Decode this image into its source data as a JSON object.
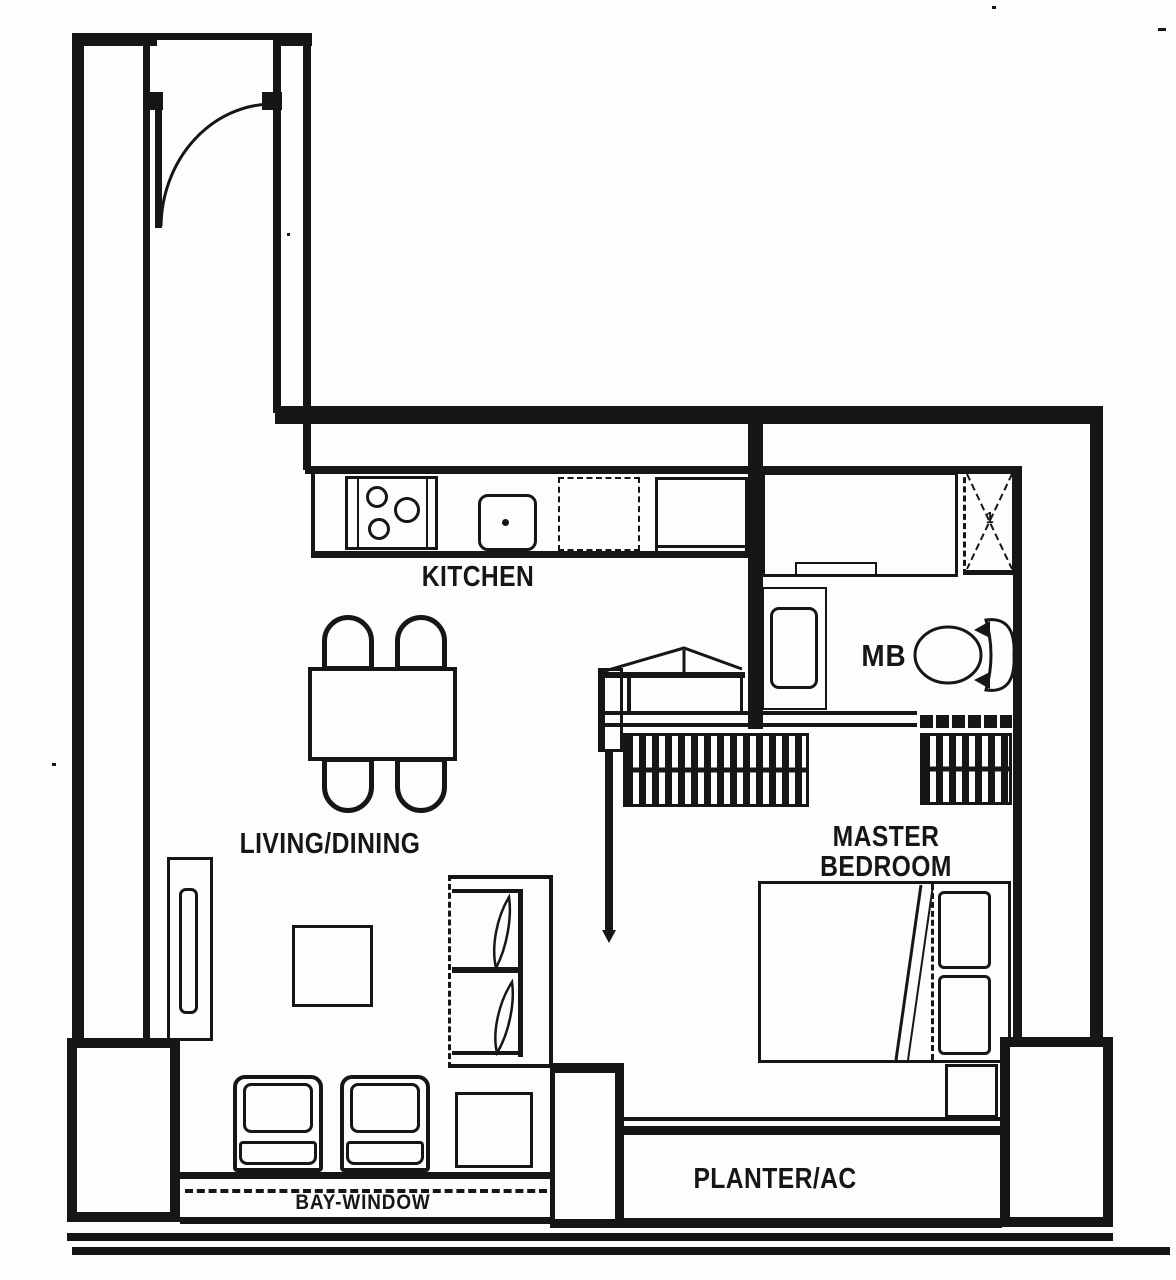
{
  "page": {
    "background": "#fdfdfd",
    "ink": "#161616"
  },
  "plan": {
    "rooms": {
      "kitchen": "KITCHEN",
      "living_dining": "LIVING/DINING",
      "master_line1": "MASTER",
      "master_line2": "BEDROOM",
      "master_bath": "MB",
      "planter": "PLANTER/AC",
      "bay_window": "BAY-WINDOW"
    },
    "marks": {
      "shower_drain": "1"
    },
    "fixtures": [
      "entry-door",
      "stove",
      "kitchen-sink",
      "refrigerator-space",
      "kitchen-counter",
      "dining-table",
      "dining-chair",
      "tv-console",
      "tv",
      "coffee-table",
      "sofa",
      "armchair",
      "side-table",
      "sliding-door",
      "wardrobe",
      "vanity-counter",
      "wash-basin",
      "toilet",
      "shower",
      "bed",
      "pillow",
      "bedside-ledge"
    ]
  }
}
